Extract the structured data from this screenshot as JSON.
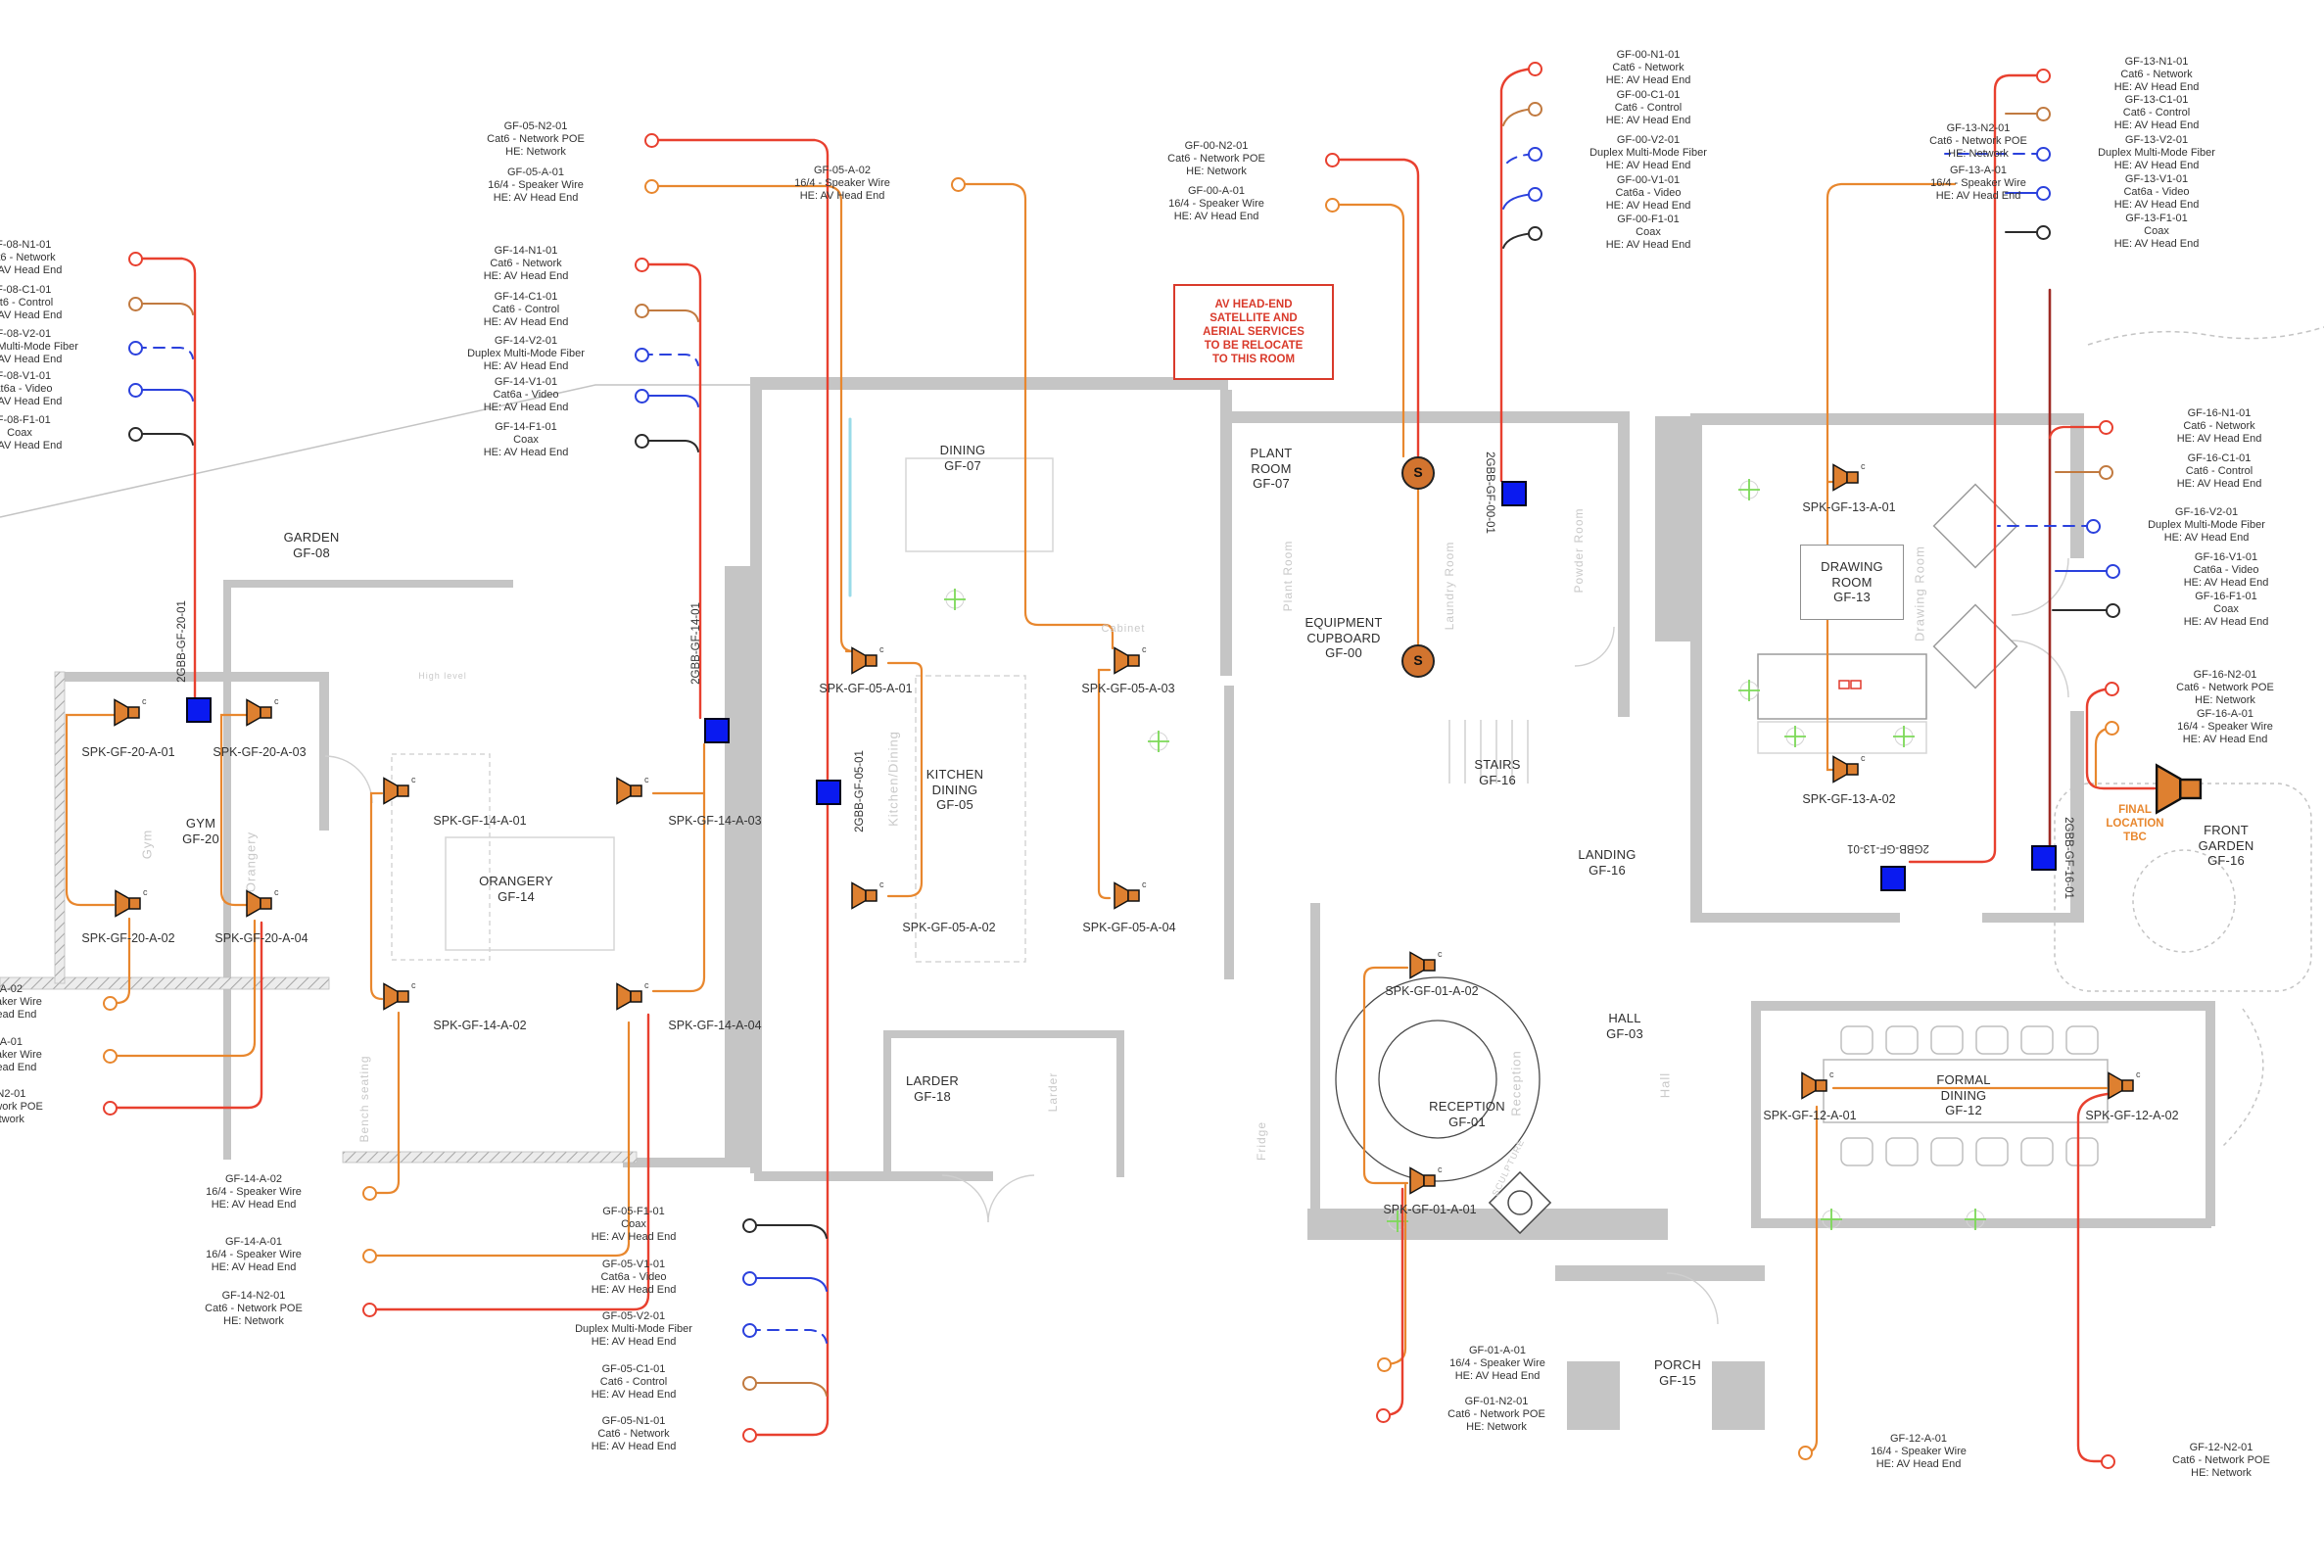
{
  "colors": {
    "red": "#e8402f",
    "orange": "#e8872e",
    "control": "#c17a40",
    "blue": "#2b41dd",
    "black": "#2b2b2b",
    "darkred": "#9e2b25",
    "cyan": "#99dbe8",
    "panel": "#0a1af0",
    "speaker": "#de8030",
    "green": "#7cd957",
    "note": "#d93a2b",
    "wall": "#c5c5c5"
  },
  "note": {
    "text": "AV HEAD-END\nSATELLITE AND\nAERIAL SERVICES\nTO BE RELOCATE\nTO THIS ROOM"
  },
  "final_location": {
    "text": "FINAL\nLOCATION\nTBC"
  },
  "symbols": {
    "speaker_tag": "c",
    "equipment_symbol": "S"
  },
  "rooms": [
    {
      "id": "garden",
      "label": "GARDEN\nGF-08"
    },
    {
      "id": "gym",
      "label": "GYM\nGF-20"
    },
    {
      "id": "orangery",
      "label": "ORANGERY\nGF-14"
    },
    {
      "id": "dining",
      "label": "DINING\nGF-07"
    },
    {
      "id": "kitchen",
      "label": "KITCHEN\nDINING\nGF-05"
    },
    {
      "id": "larder",
      "label": "LARDER\nGF-18"
    },
    {
      "id": "plant",
      "label": "PLANT\nROOM\nGF-07"
    },
    {
      "id": "equipment",
      "label": "EQUIPMENT\nCUPBOARD\nGF-00"
    },
    {
      "id": "stairs",
      "label": "STAIRS\nGF-16"
    },
    {
      "id": "landing",
      "label": "LANDING\nGF-16"
    },
    {
      "id": "hall",
      "label": "HALL\nGF-03"
    },
    {
      "id": "reception",
      "label": "RECEPTION\nGF-01"
    },
    {
      "id": "porch",
      "label": "PORCH\nGF-15"
    },
    {
      "id": "drawing",
      "label": "DRAWING\nROOM\nGF-13"
    },
    {
      "id": "formal",
      "label": "FORMAL\nDINING\nGF-12"
    },
    {
      "id": "front_garden",
      "label": "FRONT\nGARDEN\nGF-16"
    }
  ],
  "panels": [
    "2GBB-GF-20-01",
    "2GBB-GF-14-01",
    "2GBB-GF-05-01",
    "2GBB-GF-00-01",
    "2GBB-GF-13-01",
    "2GBB-GF-16-01"
  ],
  "speakers": [
    "SPK-GF-20-A-01",
    "SPK-GF-20-A-03",
    "SPK-GF-20-A-02",
    "SPK-GF-20-A-04",
    "SPK-GF-14-A-01",
    "SPK-GF-14-A-03",
    "SPK-GF-14-A-02",
    "SPK-GF-14-A-04",
    "SPK-GF-05-A-01",
    "SPK-GF-05-A-03",
    "SPK-GF-05-A-02",
    "SPK-GF-05-A-04",
    "SPK-GF-13-A-01",
    "SPK-GF-13-A-02",
    "SPK-GF-01-A-02",
    "SPK-GF-01-A-01",
    "SPK-GF-12-A-01",
    "SPK-GF-12-A-02"
  ],
  "underlay_labels": [
    "Gym",
    "Orangery",
    "Kitchen/Dining",
    "High level",
    "Bench seating",
    "Larder",
    "Fridge",
    "Plant Room",
    "Laundry Room",
    "Powder Room",
    "Reception",
    "Hall",
    "Drawing Room",
    "SCULPTURE",
    "Cabinet"
  ],
  "callouts": [
    {
      "id": "GF-08-N1-01",
      "cable": "Cat6 - Network",
      "dest": "HE: AV Head End",
      "color": "red",
      "dashed": false
    },
    {
      "id": "GF-08-C1-01",
      "cable": "Cat6 - Control",
      "dest": "HE: AV Head End",
      "color": "control",
      "dashed": false
    },
    {
      "id": "GF-08-V2-01",
      "cable": "Duplex Multi-Mode Fiber",
      "dest": "HE: AV Head End",
      "color": "blue",
      "dashed": true
    },
    {
      "id": "GF-08-V1-01",
      "cable": "Cat6a - Video",
      "dest": "HE: AV Head End",
      "color": "blue",
      "dashed": false
    },
    {
      "id": "GF-08-F1-01",
      "cable": "Coax",
      "dest": "HE: AV Head End",
      "color": "black",
      "dashed": false
    },
    {
      "id": "GF-05-N2-01",
      "cable": "Cat6 - Network POE",
      "dest": "HE: Network",
      "color": "red",
      "dashed": false
    },
    {
      "id": "GF-05-A-01",
      "cable": "16/4 - Speaker Wire",
      "dest": "HE: AV Head End",
      "color": "orange",
      "dashed": false
    },
    {
      "id": "GF-05-A-02",
      "cable": "16/4 - Speaker Wire",
      "dest": "HE: AV Head End",
      "color": "orange",
      "dashed": false
    },
    {
      "id": "GF-14-N1-01",
      "cable": "Cat6 - Network",
      "dest": "HE: AV Head End",
      "color": "red",
      "dashed": false
    },
    {
      "id": "GF-14-C1-01",
      "cable": "Cat6 - Control",
      "dest": "HE: AV Head End",
      "color": "control",
      "dashed": false
    },
    {
      "id": "GF-14-V2-01",
      "cable": "Duplex Multi-Mode Fiber",
      "dest": "HE: AV Head End",
      "color": "blue",
      "dashed": true
    },
    {
      "id": "GF-14-V1-01",
      "cable": "Cat6a - Video",
      "dest": "HE: AV Head End",
      "color": "blue",
      "dashed": false
    },
    {
      "id": "GF-14-F1-01",
      "cable": "Coax",
      "dest": "HE: AV Head End",
      "color": "black",
      "dashed": false
    },
    {
      "id": "GF-00-N2-01",
      "cable": "Cat6 - Network POE",
      "dest": "HE: Network",
      "color": "red",
      "dashed": false
    },
    {
      "id": "GF-00-A-01",
      "cable": "16/4 - Speaker Wire",
      "dest": "HE: AV Head End",
      "color": "orange",
      "dashed": false
    },
    {
      "id": "GF-00-N1-01",
      "cable": "Cat6 - Network",
      "dest": "HE: AV Head End",
      "color": "red",
      "dashed": false
    },
    {
      "id": "GF-00-C1-01",
      "cable": "Cat6 - Control",
      "dest": "HE: AV Head End",
      "color": "control",
      "dashed": false
    },
    {
      "id": "GF-00-V2-01",
      "cable": "Duplex Multi-Mode Fiber",
      "dest": "HE: AV Head End",
      "color": "blue",
      "dashed": true
    },
    {
      "id": "GF-00-V1-01",
      "cable": "Cat6a - Video",
      "dest": "HE: AV Head End",
      "color": "blue",
      "dashed": false
    },
    {
      "id": "GF-00-F1-01",
      "cable": "Coax",
      "dest": "HE: AV Head End",
      "color": "black",
      "dashed": false
    },
    {
      "id": "GF-13-N2-01",
      "cable": "Cat6 - Network POE",
      "dest": "HE: Network",
      "color": "red",
      "dashed": false
    },
    {
      "id": "GF-13-A-01",
      "cable": "16/4 - Speaker Wire",
      "dest": "HE: AV Head End",
      "color": "orange",
      "dashed": false
    },
    {
      "id": "GF-13-N1-01",
      "cable": "Cat6 - Network",
      "dest": "HE: AV Head End",
      "color": "red",
      "dashed": false
    },
    {
      "id": "GF-13-C1-01",
      "cable": "Cat6 - Control",
      "dest": "HE: AV Head End",
      "color": "control",
      "dashed": false
    },
    {
      "id": "GF-13-V2-01",
      "cable": "Duplex Multi-Mode Fiber",
      "dest": "HE: AV Head End",
      "color": "blue",
      "dashed": true
    },
    {
      "id": "GF-13-V1-01",
      "cable": "Cat6a - Video",
      "dest": "HE: AV Head End",
      "color": "blue",
      "dashed": false
    },
    {
      "id": "GF-13-F1-01",
      "cable": "Coax",
      "dest": "HE: AV Head End",
      "color": "black",
      "dashed": false
    },
    {
      "id": "GF-16-N1-01",
      "cable": "Cat6 - Network",
      "dest": "HE: AV Head End",
      "color": "red",
      "dashed": false
    },
    {
      "id": "GF-16-C1-01",
      "cable": "Cat6 - Control",
      "dest": "HE: AV Head End",
      "color": "control",
      "dashed": false
    },
    {
      "id": "GF-16-V2-01",
      "cable": "Duplex Multi-Mode Fiber",
      "dest": "HE: AV Head End",
      "color": "blue",
      "dashed": true
    },
    {
      "id": "GF-16-V1-01",
      "cable": "Cat6a - Video",
      "dest": "HE: AV Head End",
      "color": "blue",
      "dashed": false
    },
    {
      "id": "GF-16-F1-01",
      "cable": "Coax",
      "dest": "HE: AV Head End",
      "color": "black",
      "dashed": false
    },
    {
      "id": "GF-16-N2-01",
      "cable": "Cat6 - Network POE",
      "dest": "HE: Network",
      "color": "red",
      "dashed": false
    },
    {
      "id": "GF-16-A-01",
      "cable": "16/4 - Speaker Wire",
      "dest": "HE: AV Head End",
      "color": "orange",
      "dashed": false
    },
    {
      "id": "GF-20-A-02",
      "cable": "16/4 - Speaker Wire",
      "dest": "HE: AV Head End",
      "color": "orange",
      "dashed": false
    },
    {
      "id": "GF-20-A-01",
      "cable": "16/4 - Speaker Wire",
      "dest": "HE: AV Head End",
      "color": "orange",
      "dashed": false
    },
    {
      "id": "GF-20-N2-01",
      "cable": "Cat6 - Network POE",
      "dest": "HE: Network",
      "color": "red",
      "dashed": false
    },
    {
      "id": "GF-14-A-02",
      "cable": "16/4 - Speaker Wire",
      "dest": "HE: AV Head End",
      "color": "orange",
      "dashed": false
    },
    {
      "id": "GF-14-A-01",
      "cable": "16/4 - Speaker Wire",
      "dest": "HE: AV Head End",
      "color": "orange",
      "dashed": false
    },
    {
      "id": "GF-14-N2-01",
      "cable": "Cat6 - Network POE",
      "dest": "HE: Network",
      "color": "red",
      "dashed": false
    },
    {
      "id": "GF-05-F1-01",
      "cable": "Coax",
      "dest": "HE: AV Head End",
      "color": "black",
      "dashed": false
    },
    {
      "id": "GF-05-V1-01",
      "cable": "Cat6a - Video",
      "dest": "HE: AV Head End",
      "color": "blue",
      "dashed": false
    },
    {
      "id": "GF-05-V2-01",
      "cable": "Duplex Multi-Mode Fiber",
      "dest": "HE: AV Head End",
      "color": "blue",
      "dashed": true
    },
    {
      "id": "GF-05-C1-01",
      "cable": "Cat6 - Control",
      "dest": "HE: AV Head End",
      "color": "control",
      "dashed": false
    },
    {
      "id": "GF-05-N1-01",
      "cable": "Cat6 - Network",
      "dest": "HE: AV Head End",
      "color": "red",
      "dashed": false
    },
    {
      "id": "GF-01-A-01",
      "cable": "16/4 - Speaker Wire",
      "dest": "HE: AV Head End",
      "color": "orange",
      "dashed": false
    },
    {
      "id": "GF-01-N2-01",
      "cable": "Cat6 - Network POE",
      "dest": "HE: Network",
      "color": "red",
      "dashed": false
    },
    {
      "id": "GF-12-A-01",
      "cable": "16/4 - Speaker Wire",
      "dest": "HE: AV Head End",
      "color": "orange",
      "dashed": false
    },
    {
      "id": "GF-12-N2-01",
      "cable": "Cat6 - Network POE",
      "dest": "HE: Network",
      "color": "red",
      "dashed": false
    }
  ]
}
